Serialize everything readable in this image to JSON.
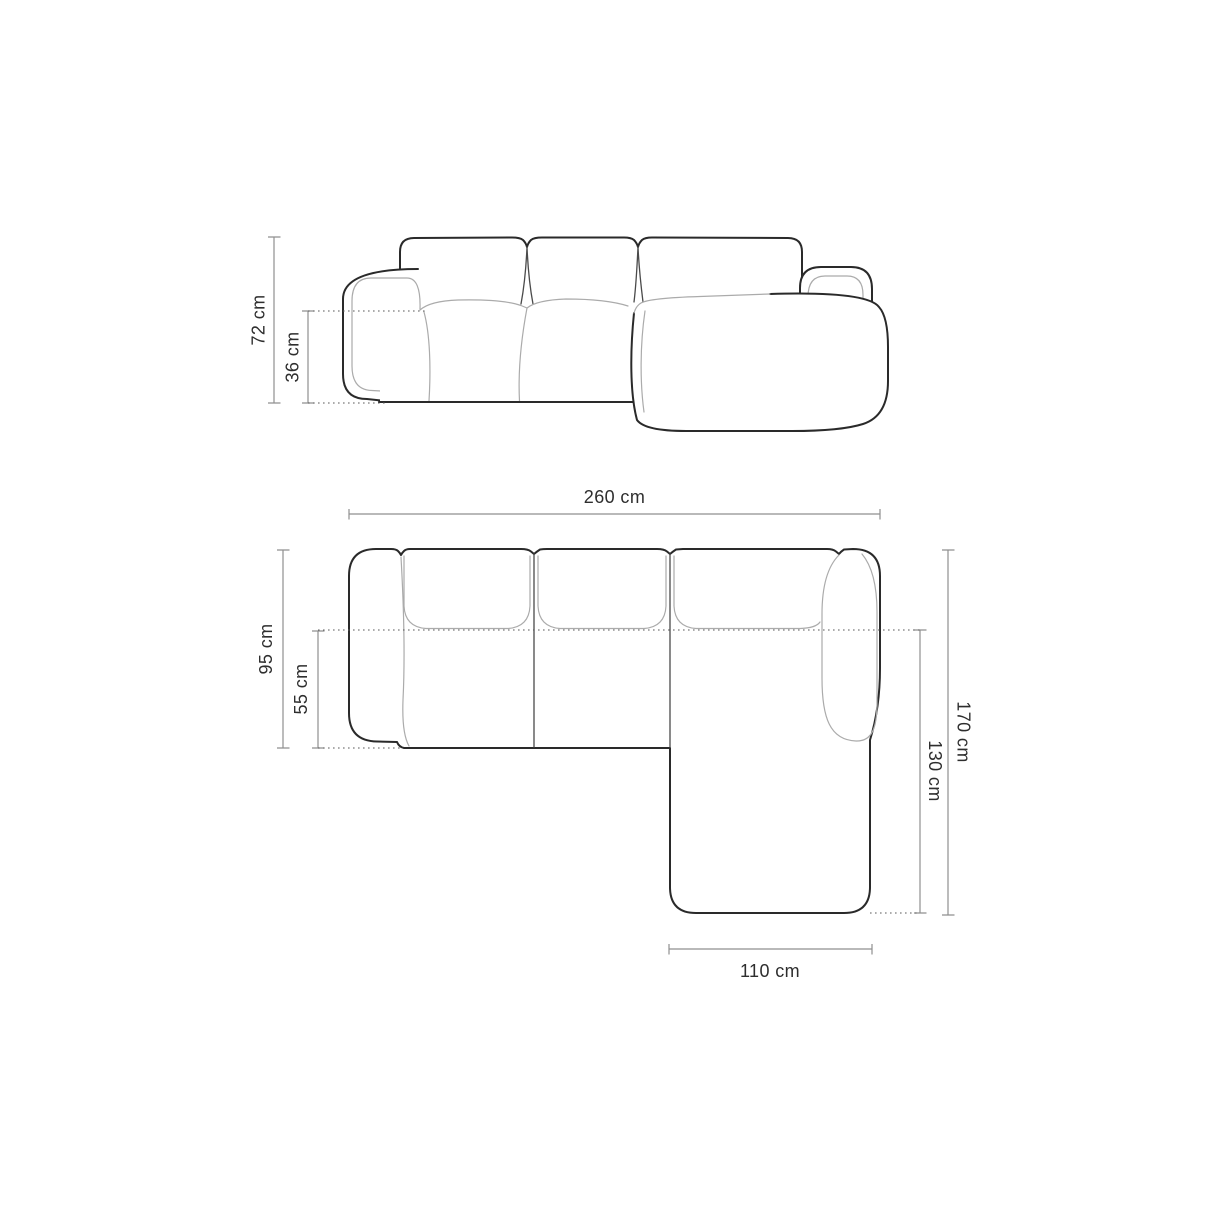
{
  "diagram": {
    "front_view": {
      "dimensions": {
        "total_height": {
          "value": "72 cm"
        },
        "seat_height": {
          "value": "36 cm"
        }
      }
    },
    "top_view": {
      "dimensions": {
        "total_width": {
          "value": "260 cm"
        },
        "total_depth": {
          "value": "95 cm"
        },
        "seat_depth": {
          "value": "55 cm"
        },
        "total_length": {
          "value": "170 cm"
        },
        "chaise_length": {
          "value": "130 cm"
        },
        "chaise_width": {
          "value": "110 cm"
        }
      }
    },
    "colors": {
      "outline_dark": "#2a2a2a",
      "outline_light": "#ababab",
      "dimension_line": "#8f8f8f",
      "dotted_line": "#5a5a5a",
      "label_text": "#2e2e2e",
      "background": "#ffffff"
    }
  }
}
